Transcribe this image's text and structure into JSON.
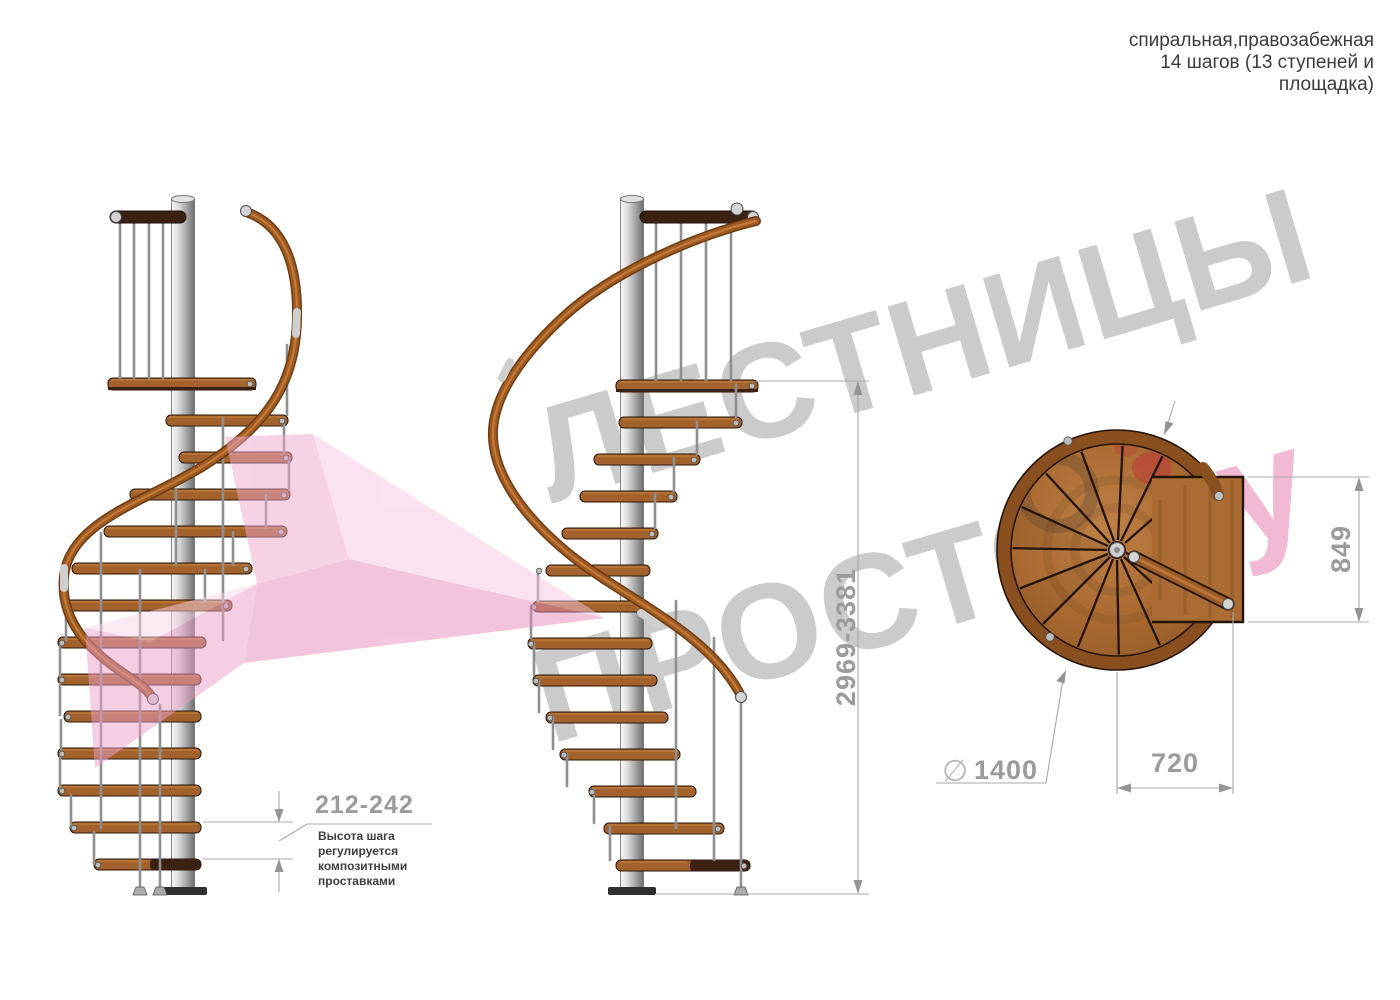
{
  "title_block": {
    "line1": "спиральная,правозабежная",
    "line2": "14 шагов (13 ступеней и",
    "line3": "площадка)"
  },
  "watermark": {
    "word1": "ЛЕСТНИЦЫ",
    "word2": "ПРОСТО",
    "suffix": ".ру"
  },
  "dims": {
    "total_height": "2969-3381",
    "step_height": "212-242",
    "note": [
      "Высота шага",
      "регулируется",
      "композитными",
      "проставками"
    ],
    "diameter_symbol": "∅",
    "diameter": "1400",
    "landing_width": "720",
    "landing_depth": "849"
  },
  "colors": {
    "wood": "#a3622c",
    "dark_wood": "#3a2114",
    "handrail": "#a05a20",
    "metal_pole": "#c9c9c9",
    "dimension_gray": "#9b9b9b",
    "watermark_gray": "#cbcbcb",
    "watermark_pink": "#f2b9d4",
    "arrow_pink": "#f3c6de",
    "note_text": "#3f3f3f"
  }
}
